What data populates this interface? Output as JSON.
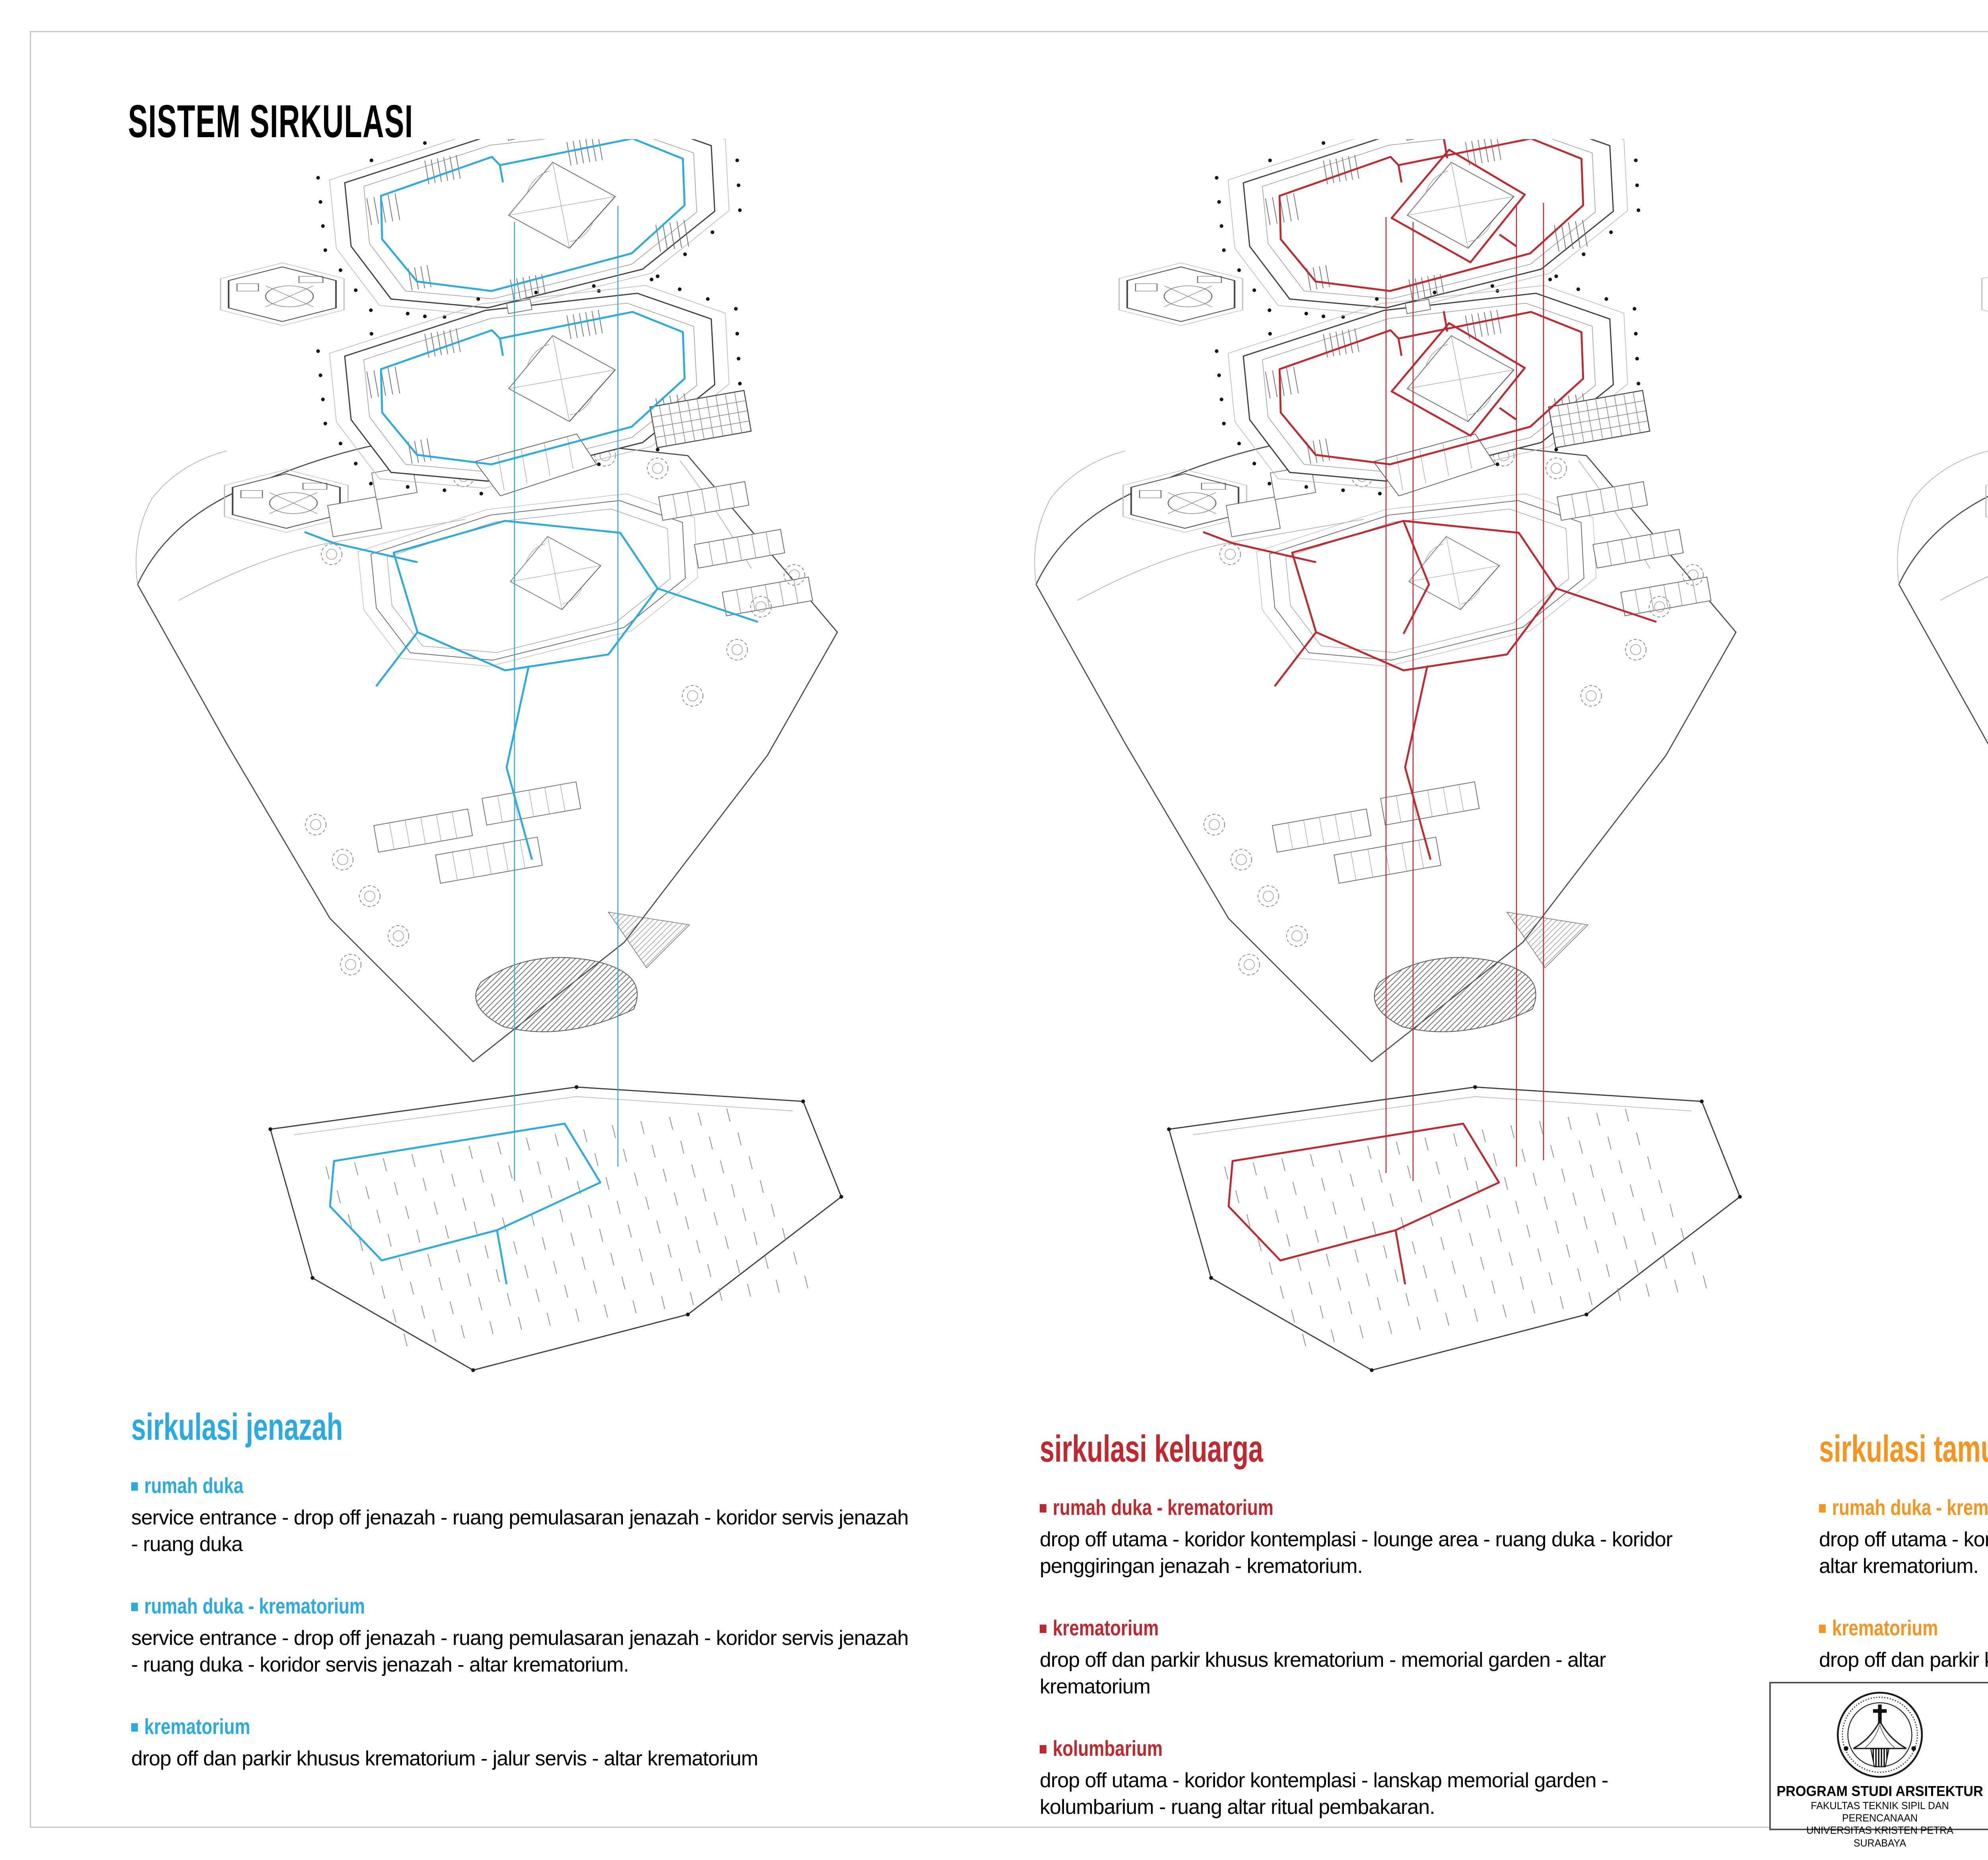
{
  "page": {
    "title": "SISTEM SIRKULASI"
  },
  "sections": [
    {
      "heading": "sirkulasi jenazah",
      "color": "#29ABE2",
      "circulation_style": "ring",
      "items": [
        {
          "label": "rumah duka",
          "text": "service entrance - drop off jenazah - ruang pemulasaran jenazah - koridor servis jenazah - ruang duka"
        },
        {
          "label": "rumah duka - krematorium",
          "text": "service entrance - drop off jenazah - ruang pemulasaran jenazah - koridor servis jenazah - ruang duka - koridor servis jenazah - altar krematorium."
        },
        {
          "label": "krematorium",
          "text": "drop off dan parkir khusus krematorium - jalur servis - altar krematorium"
        }
      ]
    },
    {
      "heading": "sirkulasi keluarga",
      "color": "#C1272D",
      "circulation_style": "both",
      "items": [
        {
          "label": "rumah duka - krematorium",
          "text": "drop off utama - koridor kontemplasi - lounge area - ruang duka - koridor penggiringan jenazah - krematorium."
        },
        {
          "label": "krematorium",
          "text": "drop off dan parkir khusus krematorium - memorial garden - altar krematorium"
        },
        {
          "label": "kolumbarium",
          "text": "drop off utama - koridor kontemplasi - lanskap memorial garden - kolumbarium - ruang altar ritual pembakaran."
        }
      ]
    },
    {
      "heading": "sirkulasi tamu",
      "color": "#F7941D",
      "circulation_style": "courtyard",
      "items": [
        {
          "label": "rumah duka - krematorium",
          "text": "drop off utama - koridor kontemplasi - lounge area - ruang duka - koridor kontemplasi - altar krematorium."
        },
        {
          "label": "krematorium",
          "text": "drop off dan parkir khusus krematorium - memorial garden - altar krematorium"
        }
      ]
    }
  ],
  "titleblock": {
    "institution": {
      "logo_icon": "universitas-kristen-petra-seal",
      "program": "PROGRAM STUDI ARSITEKTUR",
      "faculty": "FAKULTAS TEKNIK SIPIL DAN PERENCANAAN",
      "university": "UNIVERSITAS KRISTEN PETRA",
      "city": "SURABAYA"
    },
    "header": "TUGAS AKHIR - SEMESTER GENAP 2023/2024",
    "judul_tugas_label": "JUDUL TUGAS",
    "judul_tugas_line1": "FASILITAS PERSEMAYAMAN, KREMATORIUM,",
    "judul_tugas_line2": "DAN KOLUMBARIUM DI SURABAYA",
    "judul_gambar_label": "JUDUL GAMBAR",
    "judul_gambar": "SISTEM SIRKULASI",
    "skala_label": "SKALA",
    "nama_label": "NAMA",
    "nama": "STEPHANY GONDOWARDOYO",
    "nrp_label": "NRP",
    "nrp": "B12200074",
    "kelompok_label": "KELOMPOK",
    "mentor_utama_label": "MENTOR UTAMA",
    "mentor_utama": "IR. V.P. NUGROHO SUSILO, M.BDG.SC.",
    "mentor_pendamping_label": "MENTOR PENDAMPING",
    "mentor_pendamping_1": "LUCIANA KRISTANTO, S.T., M.T.",
    "mentor_pendamping_2": "IR. RIDUAN SUKARDI, M.T.",
    "mentor_pendamping_3": "RULLY DAMAYANTI , S.T., M.ART., PH.D.",
    "lembar_label": "LEMBAR",
    "jumlah_label": "JUMLAH",
    "tanggal_label": "TANGGAL",
    "pengesahan_label": "PENGESAHAN"
  }
}
